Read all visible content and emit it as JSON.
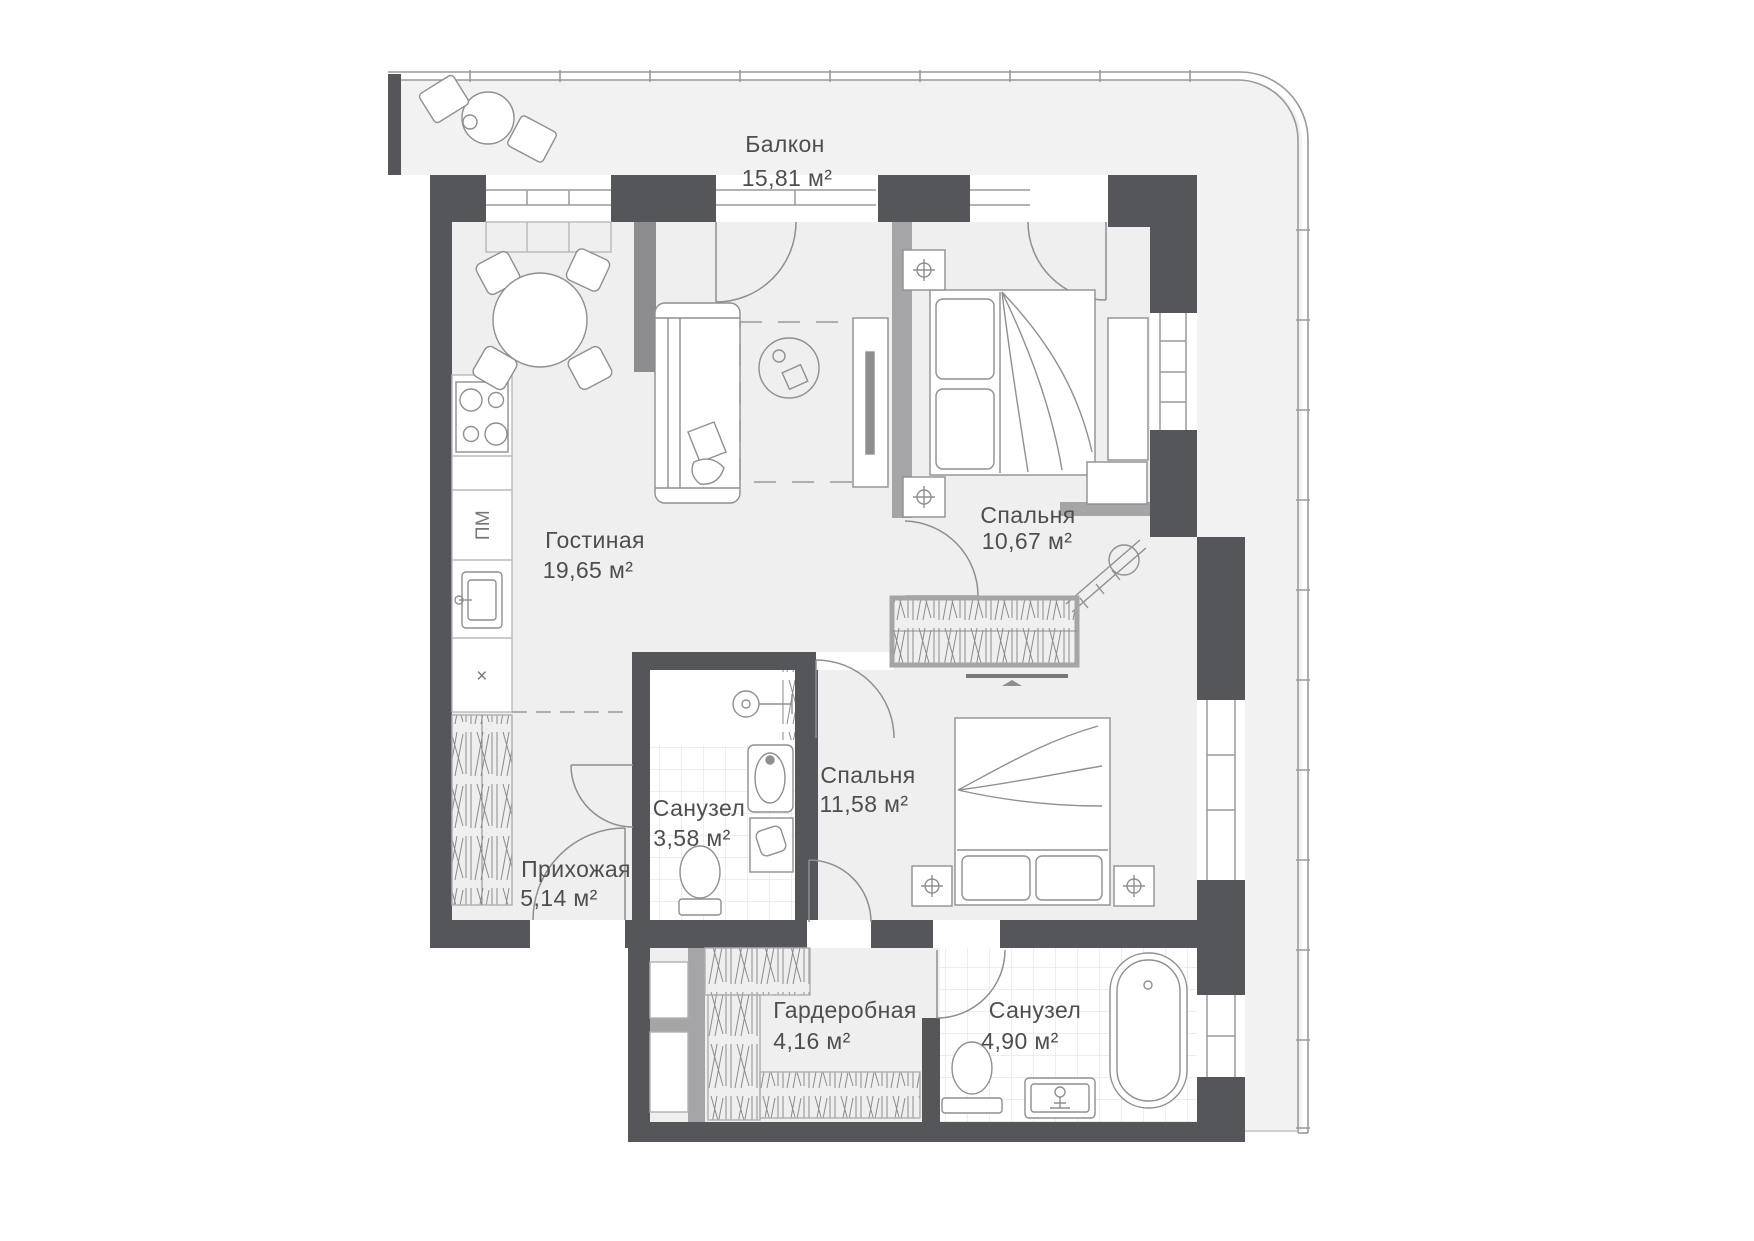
{
  "plan": {
    "rooms": [
      {
        "id": "balcony",
        "name": "Балкон",
        "area": "15,81 м²"
      },
      {
        "id": "living",
        "name": "Гостиная",
        "area": "19,65 м²"
      },
      {
        "id": "bedroom1",
        "name": "Спальня",
        "area": "10,67 м²"
      },
      {
        "id": "bedroom2",
        "name": "Спальня",
        "area": "11,58 м²"
      },
      {
        "id": "bath1",
        "name": "Санузел",
        "area": "3,58 м²"
      },
      {
        "id": "hall",
        "name": "Прихожая",
        "area": "5,14 м²"
      },
      {
        "id": "wardrobe",
        "name": "Гардеробная",
        "area": "4,16 м²"
      },
      {
        "id": "bath2",
        "name": "Санузел",
        "area": "4,90 м²"
      }
    ],
    "kitchen": {
      "dishwasher_label": "ПМ",
      "vent_label": "×"
    },
    "colors": {
      "wall_dark": "#55565a",
      "wall_gray": "#a5a5a7",
      "floor": "#efeff0",
      "balcony_floor": "#f2f2f3",
      "line": "#8f8f92",
      "tile": "#e2e2e4",
      "text": "#4e4e50"
    }
  }
}
